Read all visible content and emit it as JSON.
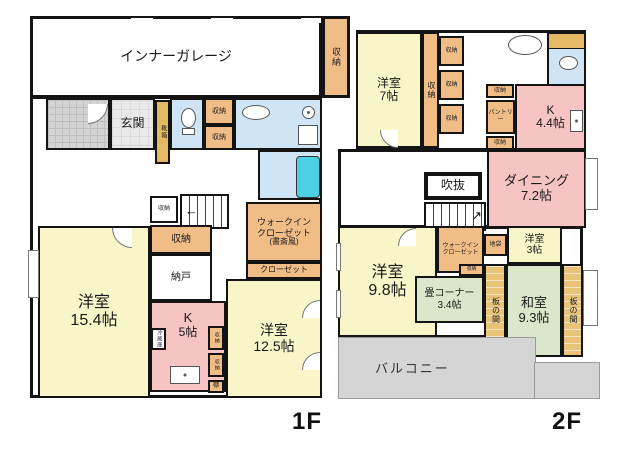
{
  "colors": {
    "room_yellow": "#f8f6c9",
    "room_pink": "#f6c4c2",
    "closet_orange": "#f1bd87",
    "wet_blue": "#cfe5f5",
    "tatami_green": "#dbe7ca",
    "itanoma_tan": "#e9c478",
    "balcony_gray": "#d5d5d5",
    "tub_cyan": "#4ad2e2",
    "wall_black": "#141414"
  },
  "f1": {
    "floor_label": "1F",
    "garage": {
      "label": "インナーガレージ"
    },
    "storage_ne": {
      "label": "収納"
    },
    "genkan": {
      "label": "玄関"
    },
    "shoe_cabinet": {
      "label": "靴箱"
    },
    "storage_hall_1": {
      "label": "収納"
    },
    "storage_hall_2": {
      "label": "収納"
    },
    "storage_stair": {
      "label": "収納"
    },
    "storage_center": {
      "label": "収納"
    },
    "nando": {
      "label": "納戸"
    },
    "living": {
      "name": "洋室",
      "size": "15.4帖"
    },
    "kitchen": {
      "name": "K",
      "size": "5帖"
    },
    "fridge": {
      "label": "冷蔵庫"
    },
    "storage_k1": {
      "label": "収納"
    },
    "storage_k2": {
      "label": "収納"
    },
    "shelf": {
      "label": "棚"
    },
    "bedroom": {
      "name": "洋室",
      "size": "12.5帖"
    },
    "wic": {
      "line1": "ウォークイン",
      "line2": "クローゼット",
      "line3": "(書斎風)"
    },
    "closet": {
      "label": "クローゼット"
    }
  },
  "f2": {
    "floor_label": "2F",
    "bedroom7": {
      "name": "洋室",
      "size": "7帖"
    },
    "storage_strip": {
      "label": "収納"
    },
    "storage_hall_1": {
      "label": "収納"
    },
    "storage_hall_2": {
      "label": "収納"
    },
    "storage_hall_3": {
      "label": "収納"
    },
    "storage_pantry_top": {
      "label": "収納"
    },
    "pantry": {
      "label": "パントリー"
    },
    "kitchen": {
      "name": "K",
      "size": "4.4帖"
    },
    "storage_pantry_bottom": {
      "label": "収納"
    },
    "dining": {
      "name": "ダイニング",
      "size": "7.2帖"
    },
    "fukinuke": {
      "label": "吹抜"
    },
    "wic": {
      "line1": "ウォークイン",
      "line2": "クローゼット"
    },
    "jibukuro": {
      "label": "地袋"
    },
    "bedroom3": {
      "name": "洋室",
      "size": "3帖"
    },
    "storage_wic": {
      "label": "収納"
    },
    "tatami_corner": {
      "name": "畳コーナー",
      "size": "3.4帖"
    },
    "itanoma_left": {
      "label": "板の間"
    },
    "washitsu": {
      "name": "和室",
      "size": "9.3帖"
    },
    "itanoma_right": {
      "label": "板の間"
    },
    "balcony": {
      "label": "バルコニー"
    }
  }
}
